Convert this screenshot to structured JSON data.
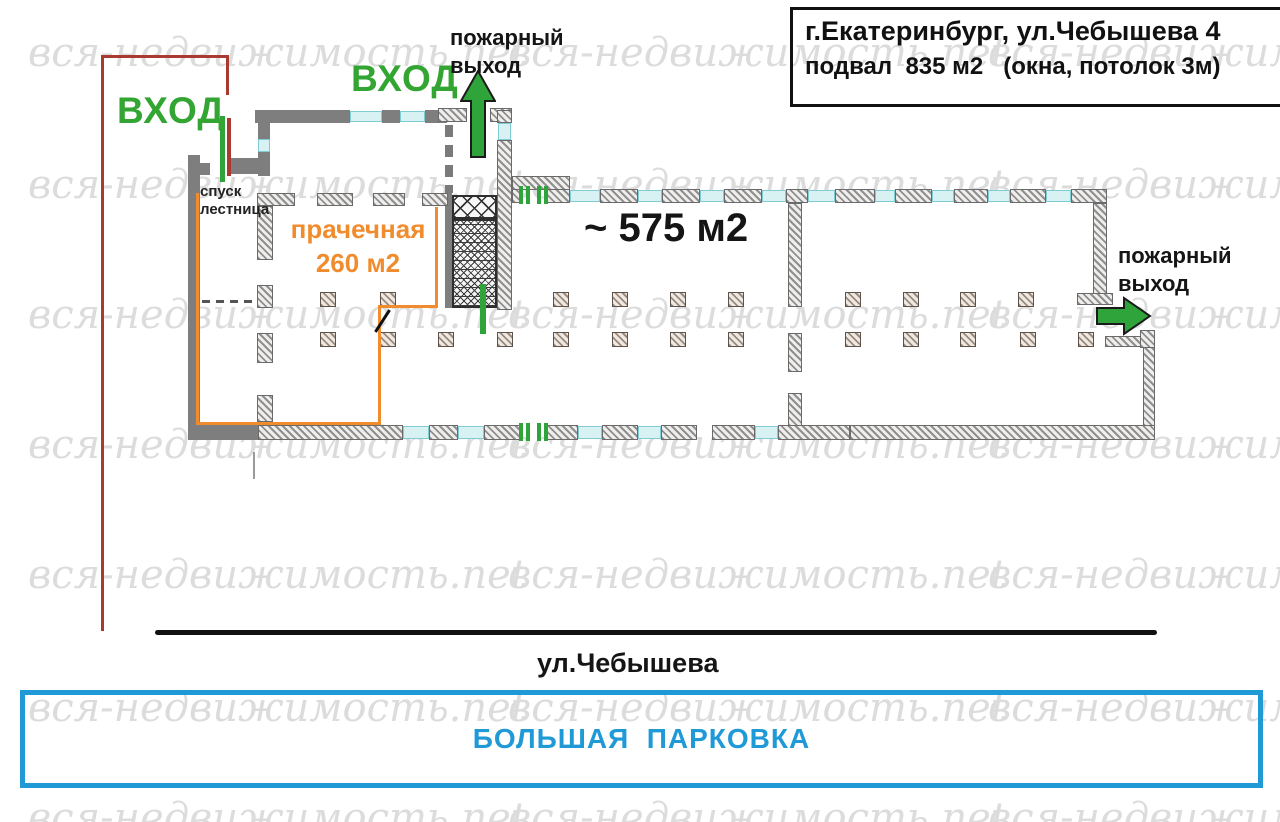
{
  "address_box": {
    "line1": "г.Екатеринбург, ул.Чебышева 4",
    "line2": "подвал  835 м2   (окна, потолок 3м)"
  },
  "labels": {
    "entrance_left": "ВХОД",
    "entrance_top": "ВХОД",
    "fire_exit_top_line1": "пожарный",
    "fire_exit_top_line2": "выход",
    "fire_exit_right_line1": "пожарный",
    "fire_exit_right_line2": "выход",
    "stairs_line1": "спуск",
    "stairs_line2": "лестница",
    "laundry_line1": "прачечная",
    "laundry_line2": "260 м2",
    "hall_area": "~ 575 м2",
    "street": "ул.Чебышева",
    "parking": "БОЛЬШАЯ  ПАРКОВКА"
  },
  "watermark": {
    "text": "вся-недвижимость.net"
  },
  "colors": {
    "green_accent": "#33a532",
    "orange_accent": "#f08c2e",
    "dark_red_accent": "#a93a31",
    "blue_accent": "#1f9ad7",
    "wall_gray": "#7e7e7e",
    "window_cyan": "#d8f1f3",
    "watermark_gray": "#dcdcdc"
  }
}
